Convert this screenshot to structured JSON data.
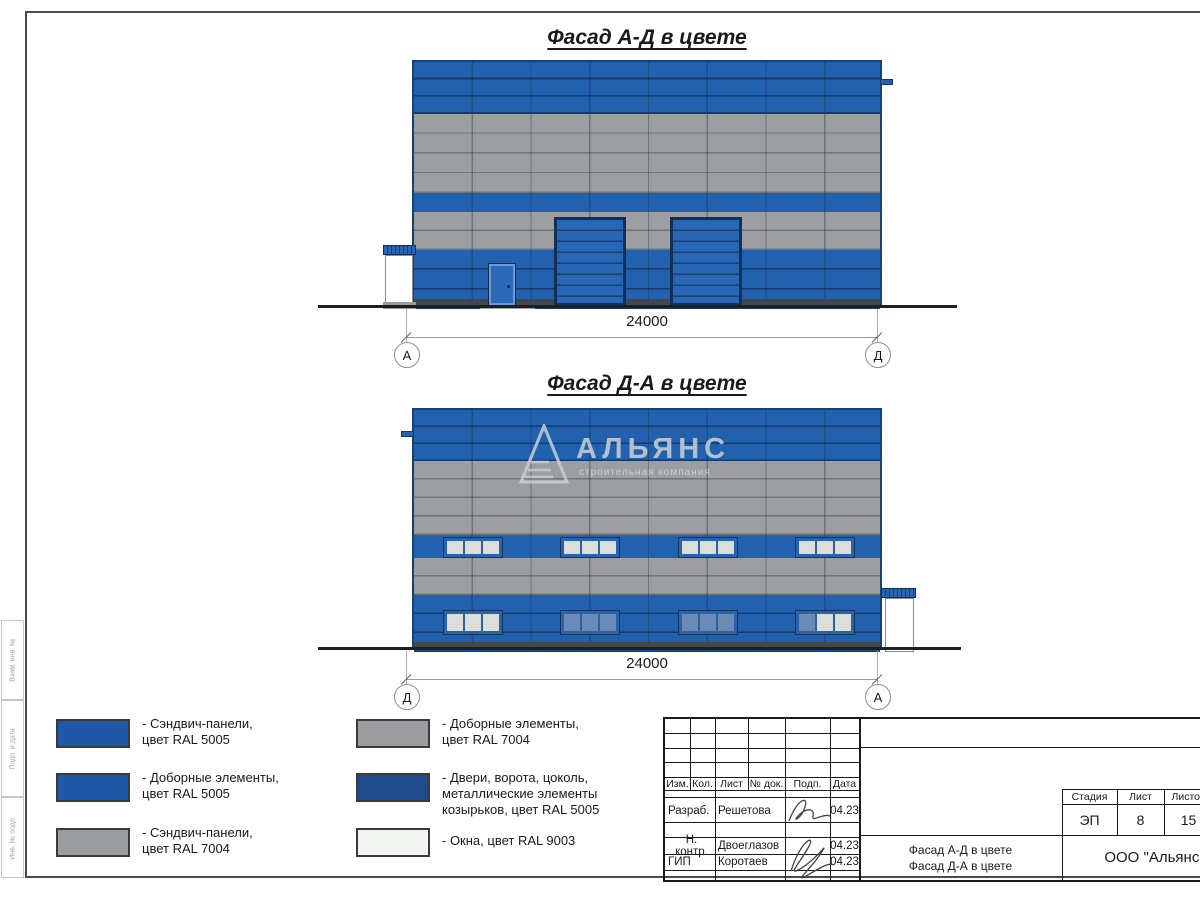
{
  "sheet": {
    "facade1": {
      "title": "Фасад А-Д в цвете",
      "dim": "24000",
      "axis_left": "А",
      "axis_right": "Д"
    },
    "facade2": {
      "title": "Фасад Д-А в цвете",
      "dim": "24000",
      "axis_left": "Д",
      "axis_right": "А"
    },
    "watermark": {
      "name": "АЛЬЯНС",
      "tagline": "строительная компания"
    }
  },
  "legend": {
    "items": [
      {
        "color": "#1e59a8",
        "text": "- Сэндвич-панели,\nцвет RAL 5005"
      },
      {
        "color": "#1e59a8",
        "text": "- Доборные элементы,\nцвет RAL 5005"
      },
      {
        "color": "#9b9da0",
        "text": "- Сэндвич-панели,\nцвет RAL 7004"
      },
      {
        "color": "#9b9da0",
        "text": "- Доборные элементы,\nцвет RAL 7004"
      },
      {
        "color": "#1d4b8d",
        "text": "- Двери, ворота, цоколь,\nметаллические элементы\nкозырьков, цвет RAL 5005"
      },
      {
        "color": "#f1f6f3",
        "text": "- Окна, цвет RAL 9003"
      }
    ]
  },
  "title_block": {
    "columns": [
      "Изм.",
      "Кол.",
      "Лист",
      "№ док.",
      "Подп.",
      "Дата"
    ],
    "rows": [
      {
        "role": "Разраб.",
        "name": "Решетова",
        "date": "04.23"
      },
      {
        "role": "Н. контр.",
        "name": "Двоеглазов",
        "date": "04.23"
      },
      {
        "role": "ГИП",
        "name": "Коротаев",
        "date": "04.23"
      }
    ],
    "stage": {
      "headers": [
        "Стадия",
        "Лист",
        "Листов"
      ],
      "values": [
        "ЭП",
        "8",
        "15"
      ]
    },
    "doc_title": "Фасад А-Д в цвете\nФасад Д-А в цвете",
    "company": "ООО \"Альянс\""
  },
  "side_stamp": {
    "labels": [
      "Взам. инв. №",
      "Подп. и дата",
      "Инв. № подл."
    ]
  },
  "colors": {
    "ral5005_panels": "#2161ad",
    "ral7004_panels": "#9c9ea1",
    "ral5005_doors": "#1d4b8d",
    "ral9003_windows": "#f1f6f3"
  }
}
